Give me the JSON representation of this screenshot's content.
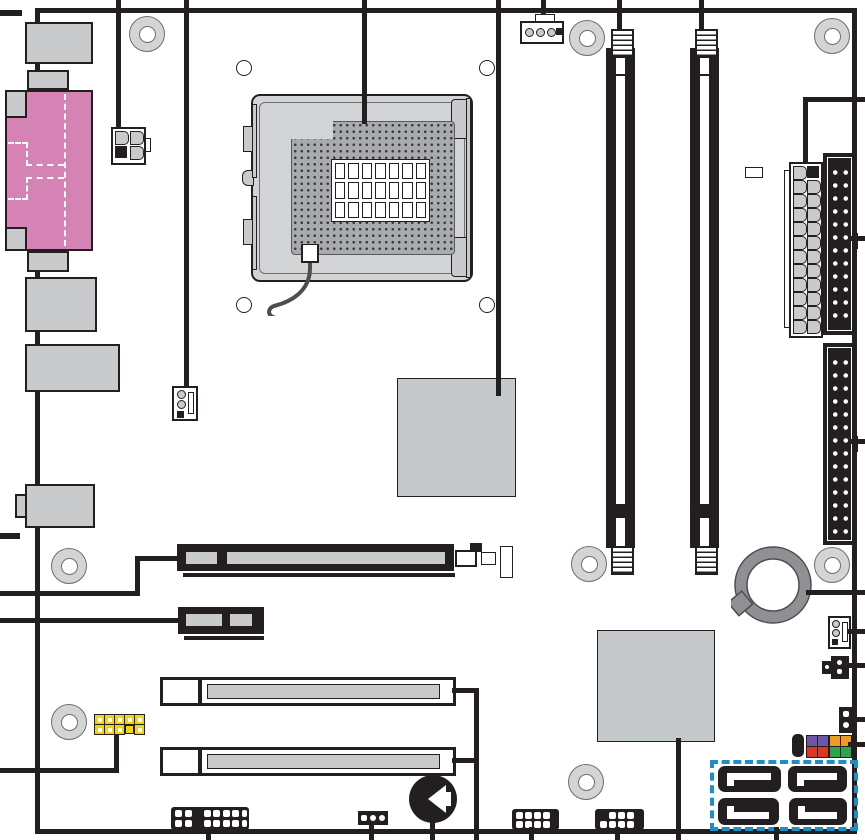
{
  "diagram": {
    "kind": "motherboard-component-layout",
    "components": [
      "back-panel-io-stack",
      "parallel-serial-panel",
      "atx12v-4pin-power-connector",
      "cpu-socket-lga",
      "cpu-fan-header-4pin",
      "rear-fan-header-3pin",
      "dimm-slot-1",
      "dimm-slot-2",
      "main-atx-power-connector-24pin",
      "floppy-connector",
      "ide-connector",
      "mch-chip",
      "ich-chip",
      "battery",
      "pcie-x16-slot",
      "pcie-x1-slot",
      "pci-slot-1",
      "pci-slot-2",
      "front-panel-usb-header-yellow",
      "speaker",
      "front-panel-header-colored",
      "sata-connector-cluster",
      "chassis-fan-header-3pin",
      "aux-connector",
      "intrusion-header-2pin",
      "mounting-holes",
      "callout-leader-lines"
    ],
    "mounting_hole_count": 8,
    "sata_connector_count": 4,
    "dimm_slot_count": 2,
    "pci_slot_count": 2
  },
  "colors": {
    "line": "#231f20",
    "component_fill": "#c9cacc",
    "chip_fill": "#c5c9cb",
    "socket_fill": "#d2d4d5",
    "pin_field": "#a8aaad",
    "panel_pink": "#d583b4",
    "battery_gray": "#8e9093",
    "hole_ring": "#d2d4d5",
    "header_yellow": "#f0d512",
    "sata_teal": "#1d8ec7",
    "fp_purple": "#6b57a5",
    "fp_red": "#dd3526",
    "fp_orange": "#f09c20",
    "fp_green": "#2ea44e"
  }
}
